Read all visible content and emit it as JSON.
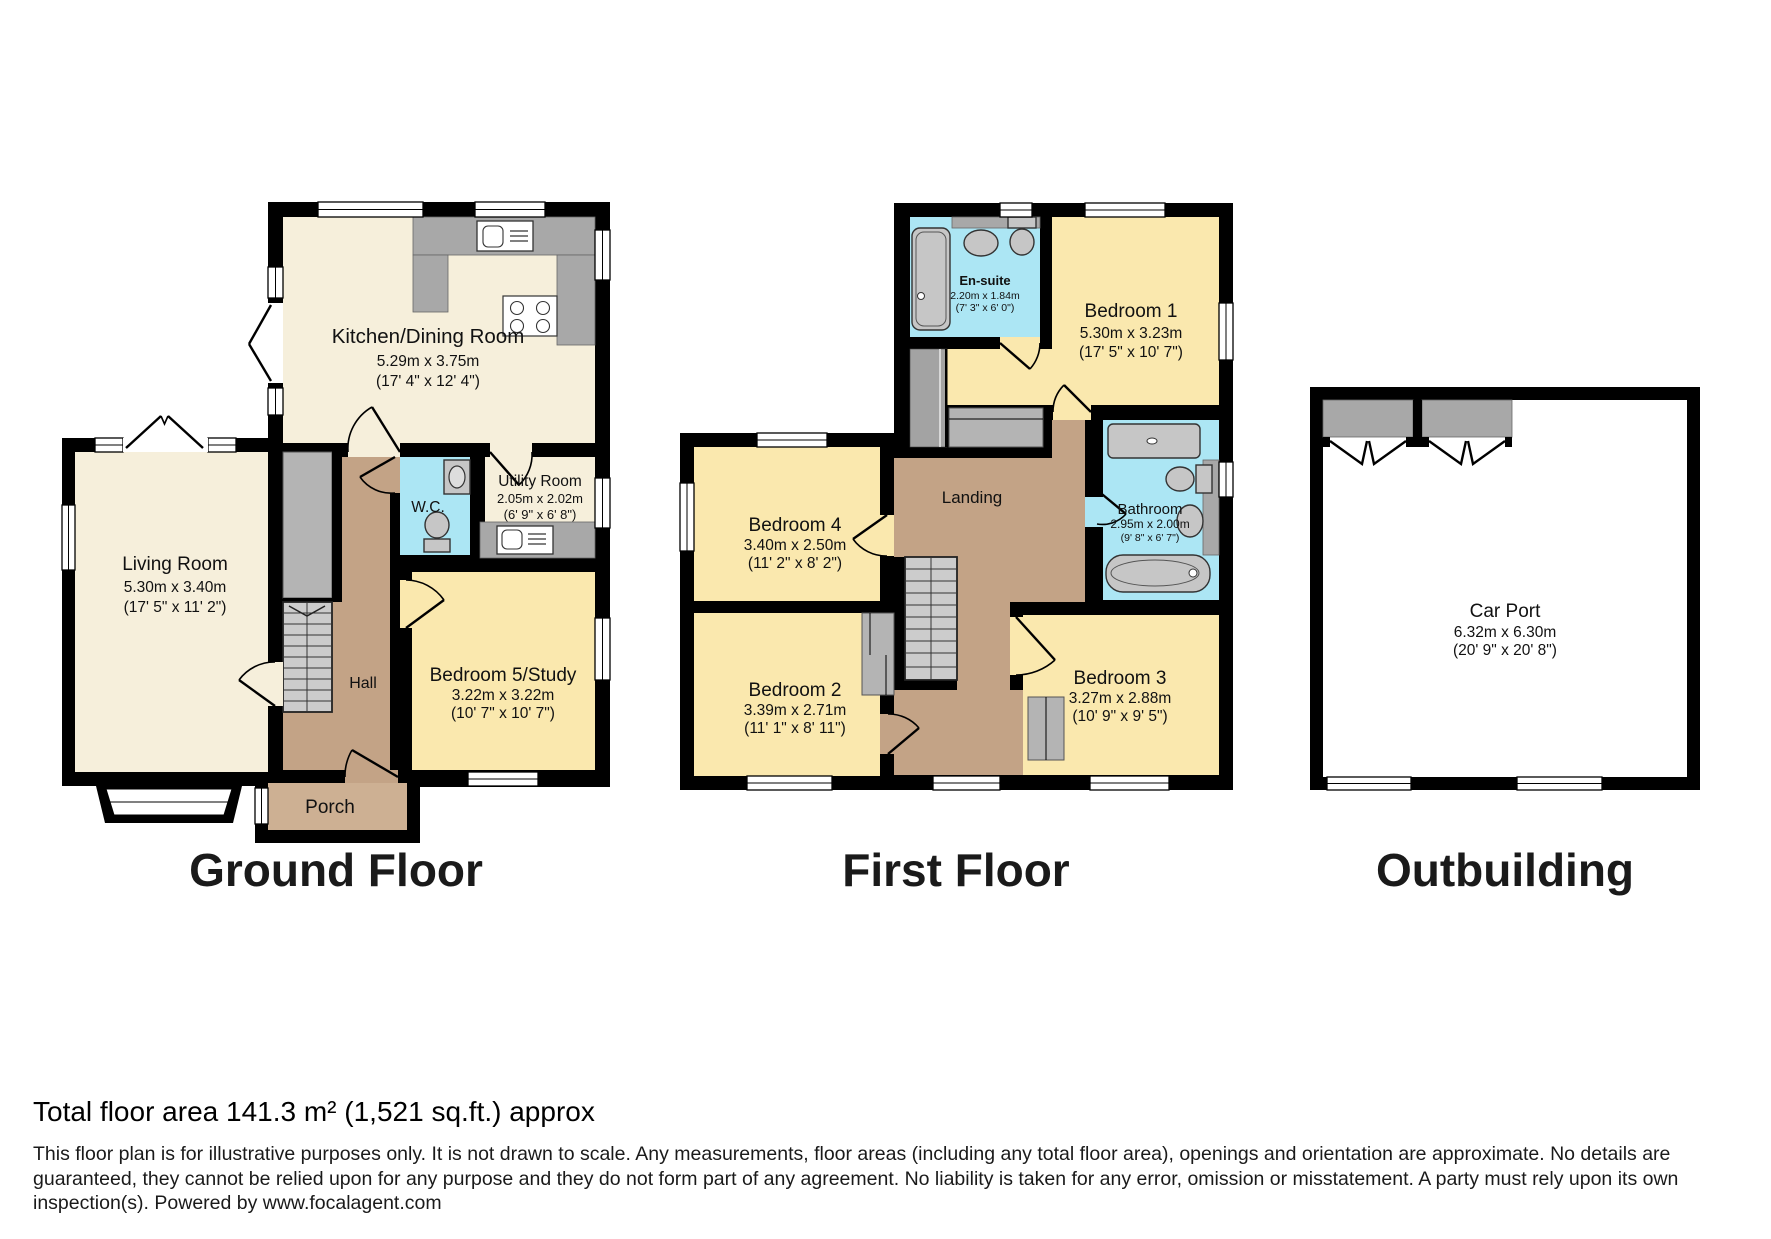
{
  "floors": {
    "ground": {
      "label": "Ground Floor",
      "rooms": {
        "kitchen": {
          "name": "Kitchen/Dining Room",
          "metric": "5.29m x 3.75m",
          "imperial": "(17' 4\" x 12' 4\")"
        },
        "living": {
          "name": "Living Room",
          "metric": "5.30m x 3.40m",
          "imperial": "(17' 5\" x 11' 2\")"
        },
        "wc": {
          "name": "W.C."
        },
        "utility": {
          "name": "Utility Room",
          "metric": "2.05m x 2.02m",
          "imperial": "(6' 9\" x 6' 8\")"
        },
        "bedroom5": {
          "name": "Bedroom 5/Study",
          "metric": "3.22m x 3.22m",
          "imperial": "(10' 7\" x 10' 7\")"
        },
        "hall": {
          "name": "Hall"
        },
        "porch": {
          "name": "Porch"
        }
      }
    },
    "first": {
      "label": "First Floor",
      "rooms": {
        "ensuite": {
          "name": "En-suite",
          "metric": "2.20m x 1.84m",
          "imperial": "(7' 3\" x 6' 0\")"
        },
        "b1": {
          "name": "Bedroom 1",
          "metric": "5.30m x 3.23m",
          "imperial": "(17' 5\" x 10' 7\")"
        },
        "b4": {
          "name": "Bedroom 4",
          "metric": "3.40m x 2.50m",
          "imperial": "(11' 2\" x 8' 2\")"
        },
        "landing": {
          "name": "Landing"
        },
        "bathroom": {
          "name": "Bathroom",
          "metric": "2.95m x 2.00m",
          "imperial": "(9' 8\" x 6' 7\")"
        },
        "b2": {
          "name": "Bedroom 2",
          "metric": "3.39m x 2.71m",
          "imperial": "(11' 1\" x 8' 11\")"
        },
        "b3": {
          "name": "Bedroom 3",
          "metric": "3.27m x 2.88m",
          "imperial": "(10' 9\" x 9' 5\")"
        }
      }
    },
    "outbuilding": {
      "label": "Outbuilding",
      "rooms": {
        "carport": {
          "name": "Car Port",
          "metric": "6.32m x 6.30m",
          "imperial": "(20' 9\" x 20' 8\")"
        }
      }
    }
  },
  "footer": {
    "total_area": "Total floor area 141.3 m² (1,521 sq.ft.) approx",
    "disclaimer": "This floor plan is for illustrative purposes only. It is not drawn to scale. Any measurements, floor areas (including any total floor area), openings and orientation are approximate. No details are guaranteed, they cannot be relied upon for any purpose and they do not form part of any agreement. No liability is taken for any error, omission or misstatement. A party must rely upon its own inspection(s). Powered by www.focalagent.com"
  },
  "colors": {
    "cream": "#f6efdb",
    "yellow": "#fae8ae",
    "brown": "#c3a386",
    "porch_brown": "#cdb093",
    "cyan": "#ace6f4",
    "wall": "#000000"
  }
}
